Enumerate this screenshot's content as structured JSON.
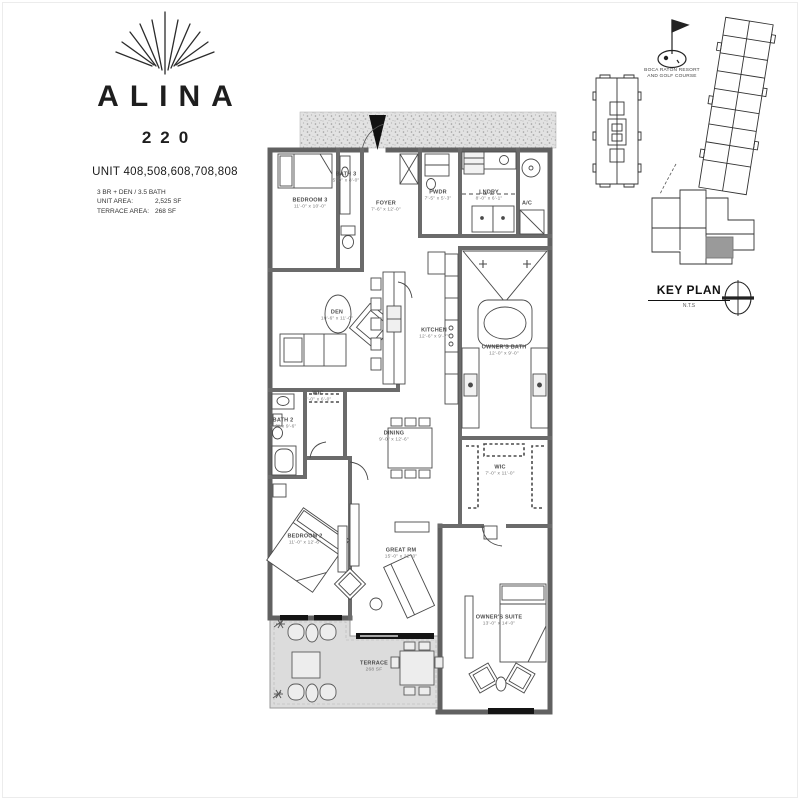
{
  "branding": {
    "logo_icon": "fan-rays-logo",
    "title": "ALINA",
    "number": "220",
    "units": "UNIT 408,508,608,708,808",
    "specs": [
      {
        "label": "3 BR + DEN / 3.5 BATH",
        "value": ""
      },
      {
        "label": "UNIT AREA:",
        "value": "2,525 SF"
      },
      {
        "label": "TERRACE AREA:",
        "value": "268 SF"
      }
    ]
  },
  "key_plan": {
    "title": "KEY PLAN",
    "scale_note": "N.T.S",
    "landmark_line1": "BOCA RATON RESORT",
    "landmark_line2": "AND GOLF COURSE",
    "icons": [
      "golf-flag-icon",
      "compass-icon"
    ]
  },
  "rooms": {
    "bedroom3": {
      "label": "BEDROOM 3",
      "dims": "11'-0\" x 10'-0\""
    },
    "bath3": {
      "label": "BATH 3",
      "dims": "5'-0\" x 8'-0\""
    },
    "foyer": {
      "label": "FOYER",
      "dims": "7'-6\" x 12'-0\""
    },
    "pwdr": {
      "label": "PWDR",
      "dims": "7'-5\" x 5'-3\""
    },
    "laundry": {
      "label": "LNDRY",
      "dims": "8'-0\" x 6'-1\""
    },
    "ac": {
      "label": "A/C",
      "dims": ""
    },
    "den": {
      "label": "DEN",
      "dims": "10'-6\" x 11'-0\""
    },
    "kitchen": {
      "label": "KITCHEN",
      "dims": "12'-6\" x 9'-7\""
    },
    "owners_bath": {
      "label": "OWNER'S BATH",
      "dims": "12'-0\" x 9'-0\""
    },
    "wic2": {
      "label": "WIC",
      "dims": "7'-0\" x 6'-0\""
    },
    "bath2": {
      "label": "BATH 2",
      "dims": "5'-0\" x 9'-6\""
    },
    "dining": {
      "label": "DINING",
      "dims": "9'-0\" x 12'-6\""
    },
    "bedroom2": {
      "label": "BEDROOM 2",
      "dims": "11'-0\" x 12'-6\""
    },
    "great_room": {
      "label": "GREAT RM",
      "dims": "15'-0\" x 22'-0\""
    },
    "owners_wic": {
      "label": "WIC",
      "dims": "7'-0\" x 11'-0\""
    },
    "owners_suite": {
      "label": "OWNER'S SUITE",
      "dims": "13'-0\" x 14'-0\""
    },
    "terrace": {
      "label": "TERRACE",
      "dims": "268 SF"
    }
  },
  "colors": {
    "wall": "#616161",
    "terrace_fill": "#dcdcdc",
    "speckle_band": "#e2e2e2",
    "line": "#4a4a4a",
    "highlight_unit": "#9a9a9a"
  }
}
